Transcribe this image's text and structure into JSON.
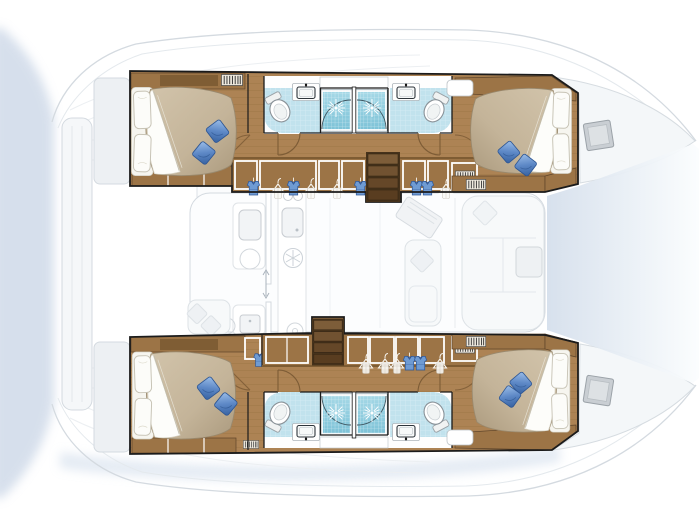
{
  "image": {
    "kind": "catamaran-interior-floor-plan-top-view",
    "width_px": 700,
    "height_px": 525,
    "orientation": {
      "bow": "right",
      "stern": "left"
    }
  },
  "colors": {
    "background": "#ffffff",
    "wood_floor": "#ad8354",
    "wood_plank_line": "#95713f",
    "wood_cabinet": "#9c7446",
    "wood_cabinet_dark": "#7f5d34",
    "stair_frame": "#46321b",
    "bed_duvet": "#c9baa0",
    "bed_duvet_deep": "#b1a084",
    "sheet_white": "#fdfdfb",
    "cushion_blue": "#4c7abb",
    "cushion_blue_light": "#95b9e6",
    "shower_tile": "#84c8dc",
    "shower_tile_light": "#a7d9e7",
    "bath_tile": "#c1e2ed",
    "fixture_white": "#ffffff",
    "fixture_line": "#8a9298",
    "sink_frame": "#2f363c",
    "wall_dark": "#1b1b1b",
    "door_arc": "#7d5c36",
    "ghost_line": "#d4dae0",
    "ghost_fill": "#f5f7f9",
    "ghost_fill_deep": "#edf0f3",
    "saloon_floor": "#fcfdfe",
    "hatch_fill": "#c9ced3",
    "hatch_line": "#9ba2a8",
    "water_shadow": "#b7c7dd",
    "bow_gradient": "#d9e2ee"
  },
  "plan": {
    "hulls": [
      {
        "id": "top-hull",
        "cabins": [
          {
            "id": "top-aft-cabin",
            "fixtures": [
              "double-bed",
              "two-pillows",
              "two-blue-cushions",
              "cabinets",
              "vent-louver"
            ]
          },
          {
            "id": "top-fwd-cabin",
            "fixtures": [
              "double-bed",
              "two-pillows",
              "two-blue-cushions",
              "cabinets",
              "vent-louver"
            ]
          }
        ],
        "bathrooms": [
          {
            "id": "top-aft-bathroom",
            "fixtures": [
              "toilet",
              "sink",
              "tiled-shower",
              "shower-door"
            ]
          },
          {
            "id": "top-fwd-bathroom",
            "fixtures": [
              "toilet",
              "sink",
              "tiled-shower",
              "shower-door"
            ]
          }
        ],
        "corridor_fixtures": [
          "wardrobe-hanging-lockers",
          "companionway-stairs",
          "door-swings"
        ]
      },
      {
        "id": "bottom-hull",
        "cabins": [
          {
            "id": "bottom-aft-cabin",
            "fixtures": [
              "double-bed",
              "two-pillows",
              "two-blue-cushions",
              "cabinets",
              "vent-louver"
            ]
          },
          {
            "id": "bottom-fwd-cabin",
            "fixtures": [
              "double-bed",
              "two-pillows",
              "two-blue-cushions",
              "cabinets",
              "vent-louver"
            ]
          }
        ],
        "bathrooms": [
          {
            "id": "bottom-aft-bathroom",
            "fixtures": [
              "toilet",
              "sink",
              "tiled-shower",
              "shower-door"
            ]
          },
          {
            "id": "bottom-fwd-bathroom",
            "fixtures": [
              "toilet",
              "sink",
              "tiled-shower",
              "shower-door"
            ]
          }
        ],
        "corridor_fixtures": [
          "wardrobe-hanging-lockers",
          "companionway-stairs",
          "door-swings"
        ]
      }
    ],
    "bridgedeck": {
      "saloon_fixtures": [
        "galley-counters",
        "galley-sink",
        "stove-burners",
        "fridge-snowflake",
        "nav-chart-table",
        "settee-sofa",
        "side-table",
        "companionway-arrow"
      ],
      "cockpit_fixtures": [
        "aft-bench-seat",
        "cockpit-tables"
      ],
      "deck_fixtures": [
        "aft-platform-steps",
        "two-bow-deck-hatches",
        "foredecks",
        "trampoline-area",
        "water-shadow"
      ]
    }
  },
  "counts": {
    "cabins": 4,
    "bathrooms": 4,
    "showers": 4,
    "toilets": 4,
    "sinks": 4,
    "double_beds": 4,
    "blue_cushions": 8,
    "companionway_stairs": 2,
    "deck_hatches": 2
  }
}
